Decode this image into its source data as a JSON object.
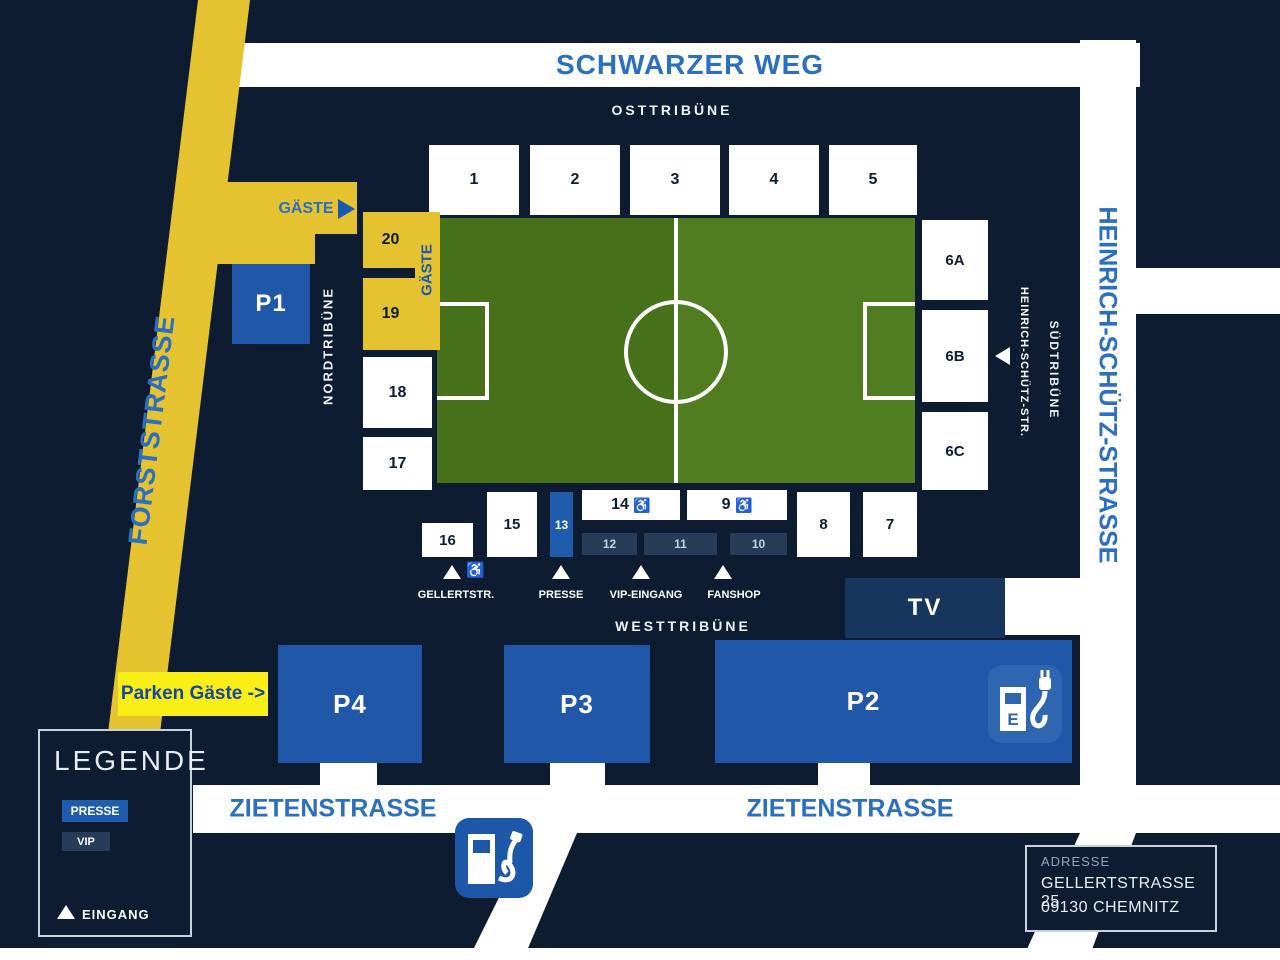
{
  "streets": {
    "schwarzer_weg": "SCHWARZER WEG",
    "forststrasse": "FORSTSTRASSE",
    "heinrich_schuetz_strasse": "HEINRICH-SCHÜTZ-STRASSE",
    "heinrich_schuetz_str_short": "HEINRICH-SCHÜTZ-STR.",
    "zietenstrasse_west": "ZIETENSTRASSE",
    "zietenstrasse_east": "ZIETENSTRASSE"
  },
  "stands": {
    "ost": "OSTTRIBÜNE",
    "nord": "NORDTRIBÜNE",
    "sued": "SÜDTRIBÜNE",
    "west": "WESTTRIBÜNE"
  },
  "sections": {
    "s1": "1",
    "s2": "2",
    "s3": "3",
    "s4": "4",
    "s5": "5",
    "s6a": "6A",
    "s6b": "6B",
    "s6c": "6C",
    "s7": "7",
    "s8": "8",
    "s9": "9",
    "s10": "10",
    "s11": "11",
    "s12": "12",
    "s13": "13",
    "s14": "14",
    "s15": "15",
    "s16": "16",
    "s17": "17",
    "s18": "18",
    "s19": "19",
    "s20": "20"
  },
  "icons": {
    "wheelchair": "♿",
    "ev_label": "E"
  },
  "guest": {
    "route_label": "GÄSTE",
    "stand_label": "GÄSTE",
    "parking_label": "Parken Gäste ->"
  },
  "parking": {
    "p1": "P1",
    "p2": "P2",
    "p3": "P3",
    "p4": "P4"
  },
  "tv_label": "TV",
  "entrances": {
    "gellertstr": "GELLERTSTR.",
    "presse": "PRESSE",
    "vip": "VIP-EINGANG",
    "fanshop": "FANSHOP"
  },
  "legend": {
    "title": "LEGENDE",
    "presse": "PRESSE",
    "vip": "VIP",
    "eingang": "EINGANG"
  },
  "address": {
    "label": "ADRESSE",
    "street": "GELLERTSTRASSE 25",
    "city": "09130 CHEMNITZ"
  },
  "colors": {
    "background": "#0d1c31",
    "road_white": "#ffffff",
    "route_yellow": "#e5c230",
    "highlight_yellow": "#f9ee15",
    "parking_blue": "#2057a8",
    "press_blue": "#1f5cae",
    "vip_navy": "#273c59",
    "tv_navy": "#16365d",
    "street_text_blue": "#2b6fc2",
    "pitch_green_left": "#47701b",
    "pitch_green_right": "#4f7d20",
    "text_navy": "#0d1c31"
  }
}
